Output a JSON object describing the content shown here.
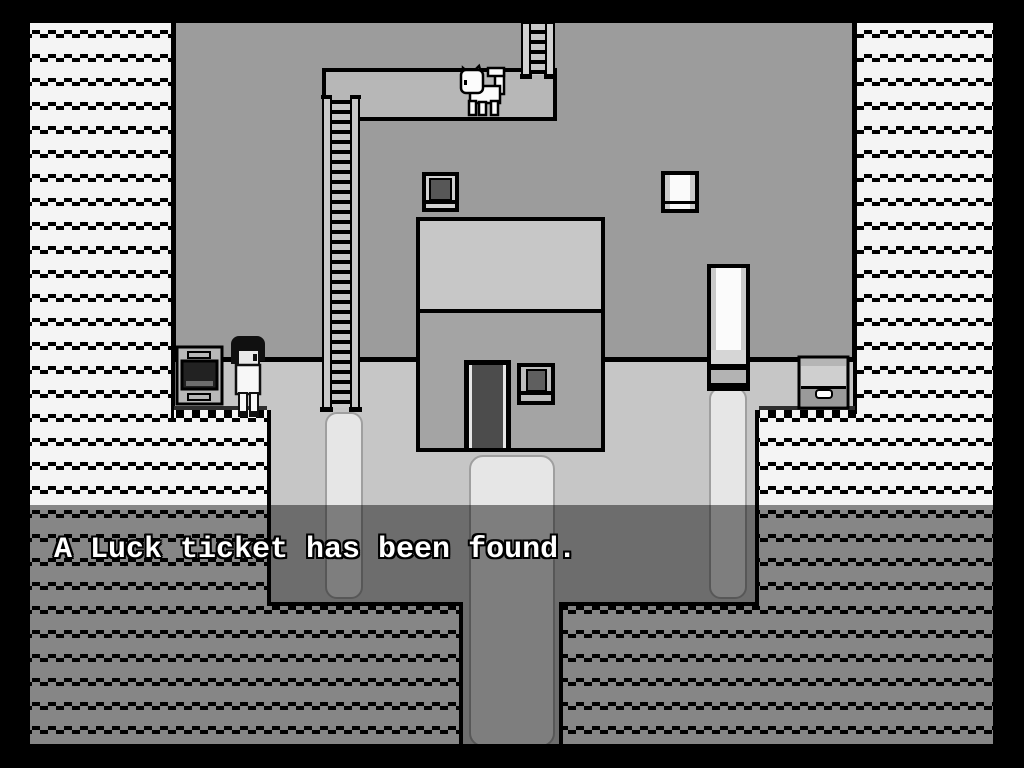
{
  "screen": {
    "width": 1024,
    "height": 768
  },
  "message": {
    "text": "A Luck ticket has been found."
  },
  "palette": {
    "border_black": "#000000",
    "wall": "#9c9c9c",
    "ledge": "#b7b7b7",
    "roof": "#c7c7c7",
    "house_wall": "#a4a4a4",
    "floor": "#c6c6c6",
    "path": "#e6e6e6",
    "pattern_bg": "#f4f4f4",
    "door_dark": "#4c4c4c",
    "window_dark": "#575757",
    "white_fill": "#fbfbfb",
    "dim": "rgba(0,0,0,0.45)",
    "text": "#ffffff"
  },
  "scene": {
    "sprites": [
      {
        "name": "player-character"
      },
      {
        "name": "white-cat"
      },
      {
        "name": "roof-ladder"
      },
      {
        "name": "long-ladder"
      },
      {
        "name": "stove"
      },
      {
        "name": "treasure-chest"
      },
      {
        "name": "house"
      },
      {
        "name": "house-door"
      },
      {
        "name": "house-window"
      },
      {
        "name": "dark-wall-window"
      },
      {
        "name": "white-wall-window"
      },
      {
        "name": "tall-white-door"
      }
    ]
  }
}
